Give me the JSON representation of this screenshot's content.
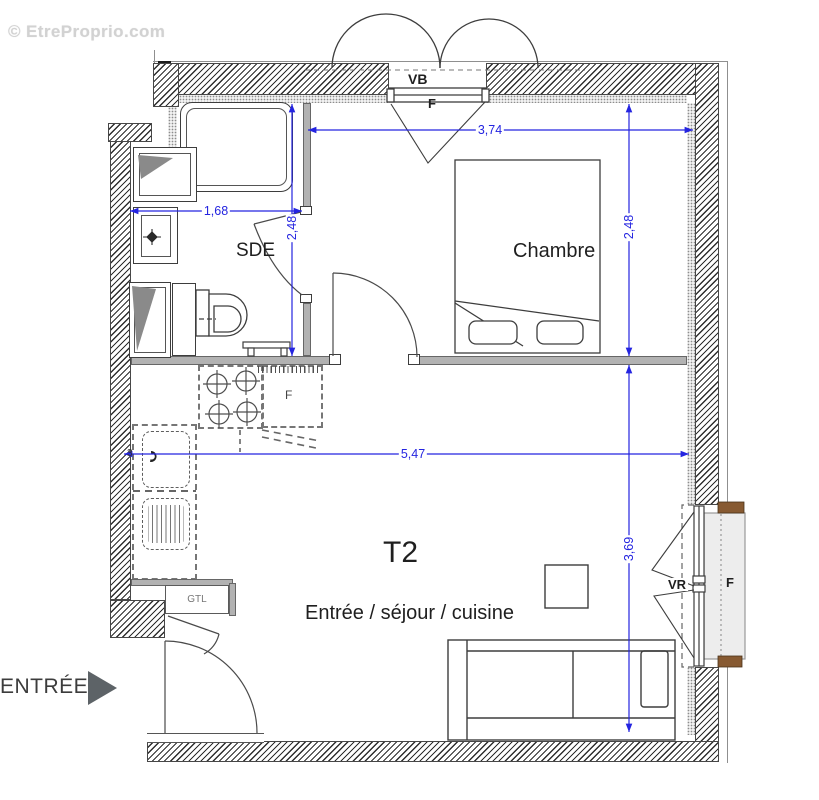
{
  "watermark": "© EtreProprio.com",
  "title": "T2",
  "rooms": {
    "bathroom": "SDE",
    "bedroom": "Chambre",
    "living": "Entrée / séjour / cuisine"
  },
  "labels": {
    "vb": "VB",
    "f_top": "F",
    "vr": "VR",
    "f_right": "F",
    "f_fridge": "F",
    "gtl": "GTL",
    "entrance": "ENTRÉE",
    "note": "3"
  },
  "dimensions": {
    "bedroom_width": "3,74",
    "bathroom_width": "1,68",
    "bathroom_depth": "2,48",
    "bedroom_depth": "2,48",
    "living_width": "5,47",
    "living_depth": "3,69"
  },
  "colors": {
    "dimension_blue": "#2424e0",
    "wood_brown": "#875a32",
    "wall_gray": "#b2b2b2"
  }
}
